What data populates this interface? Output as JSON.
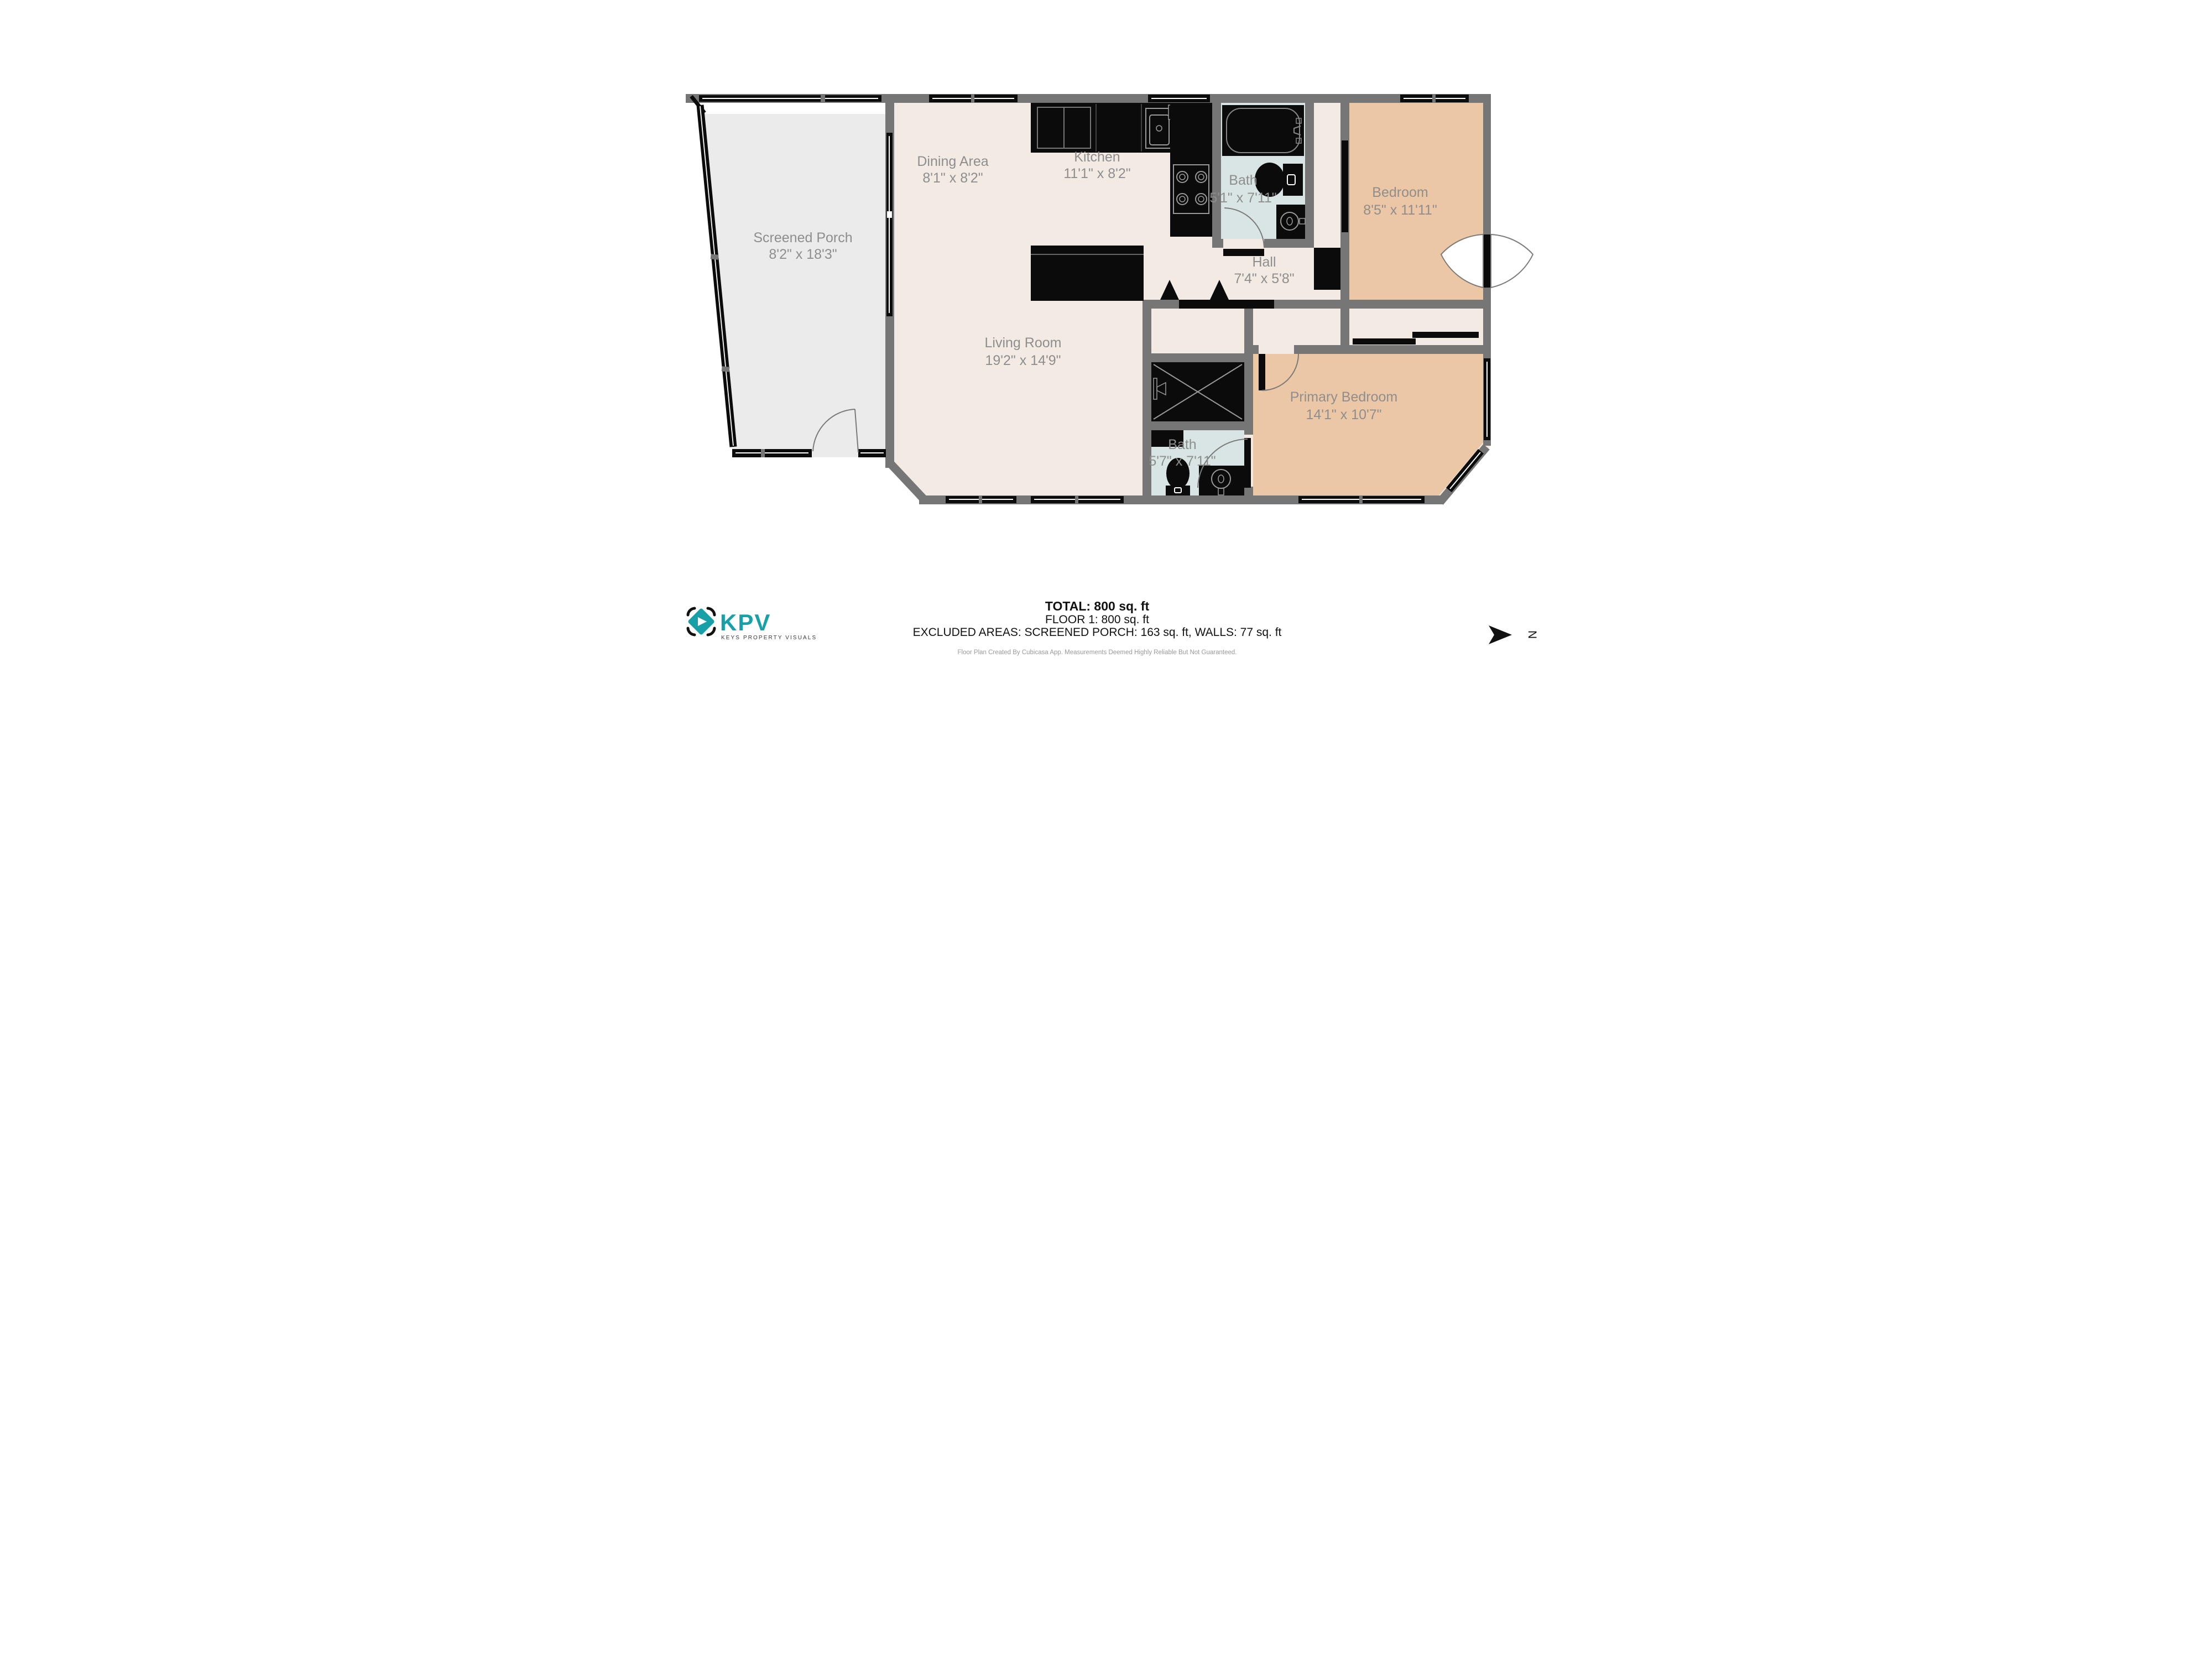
{
  "floorplan": {
    "rooms": [
      {
        "name": "Screened Porch",
        "dimensions": "8'2\" x 18'3\""
      },
      {
        "name": "Dining Area",
        "dimensions": "8'1\" x 8'2\""
      },
      {
        "name": "Kitchen",
        "dimensions": "11'1\" x 8'2\""
      },
      {
        "name": "Bath",
        "dimensions": "5'1\" x 7'11\""
      },
      {
        "name": "Bedroom",
        "dimensions": "8'5\" x 11'11\""
      },
      {
        "name": "Hall",
        "dimensions": "7'4\" x 5'8\""
      },
      {
        "name": "Living Room",
        "dimensions": "19'2\" x 14'9\""
      },
      {
        "name": "Bath",
        "dimensions": "5'7\" x 7'11\""
      },
      {
        "name": "Primary Bedroom",
        "dimensions": "14'1\" x 10'7\""
      }
    ],
    "north_label": "N",
    "colors": {
      "wall_gray": "#767676",
      "floor_cream": "#f3eae3",
      "floor_tan": "#ebc7a5",
      "floor_bath_blue": "#d9e5e4",
      "floor_porch_gray": "#ebebeb",
      "fixture_black": "#0b0b0b",
      "label_gray": "#8e8e8e",
      "brand_teal": "#17a0a8"
    }
  },
  "summary": {
    "total": "TOTAL: 800 sq. ft",
    "floor": "FLOOR 1: 800 sq. ft",
    "excluded": "EXCLUDED AREAS: SCREENED PORCH: 163 sq. ft, WALLS: 77 sq. ft",
    "disclaimer": "Floor Plan Created By Cubicasa App. Measurements Deemed Highly Reliable But Not Guaranteed."
  },
  "branding": {
    "logo_text": "KPV",
    "logo_subtext": "KEYS PROPERTY VISUALS"
  }
}
